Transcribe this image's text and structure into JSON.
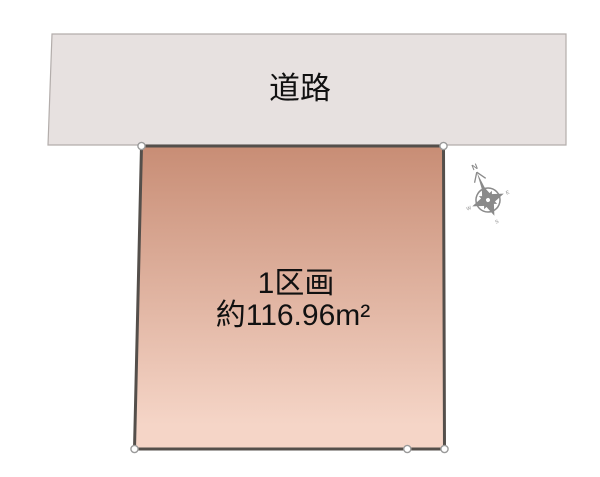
{
  "road": {
    "label": "道路",
    "fill": "#e7e1e0",
    "stroke": "#b3adab"
  },
  "plot": {
    "number_label": "1区画",
    "area_label": "約116.96m²",
    "gradient_top": "#c88d75",
    "gradient_bottom": "#f5d5c7",
    "stroke": "#544f4b"
  },
  "markers": {
    "fill": "#ffffff",
    "stroke": "#9a9a9a"
  },
  "compass": {
    "north_label": "N",
    "east_label": "E",
    "south_label": "S",
    "west_label": "W",
    "color": "#8a8a8a"
  },
  "text_color": "#111111"
}
